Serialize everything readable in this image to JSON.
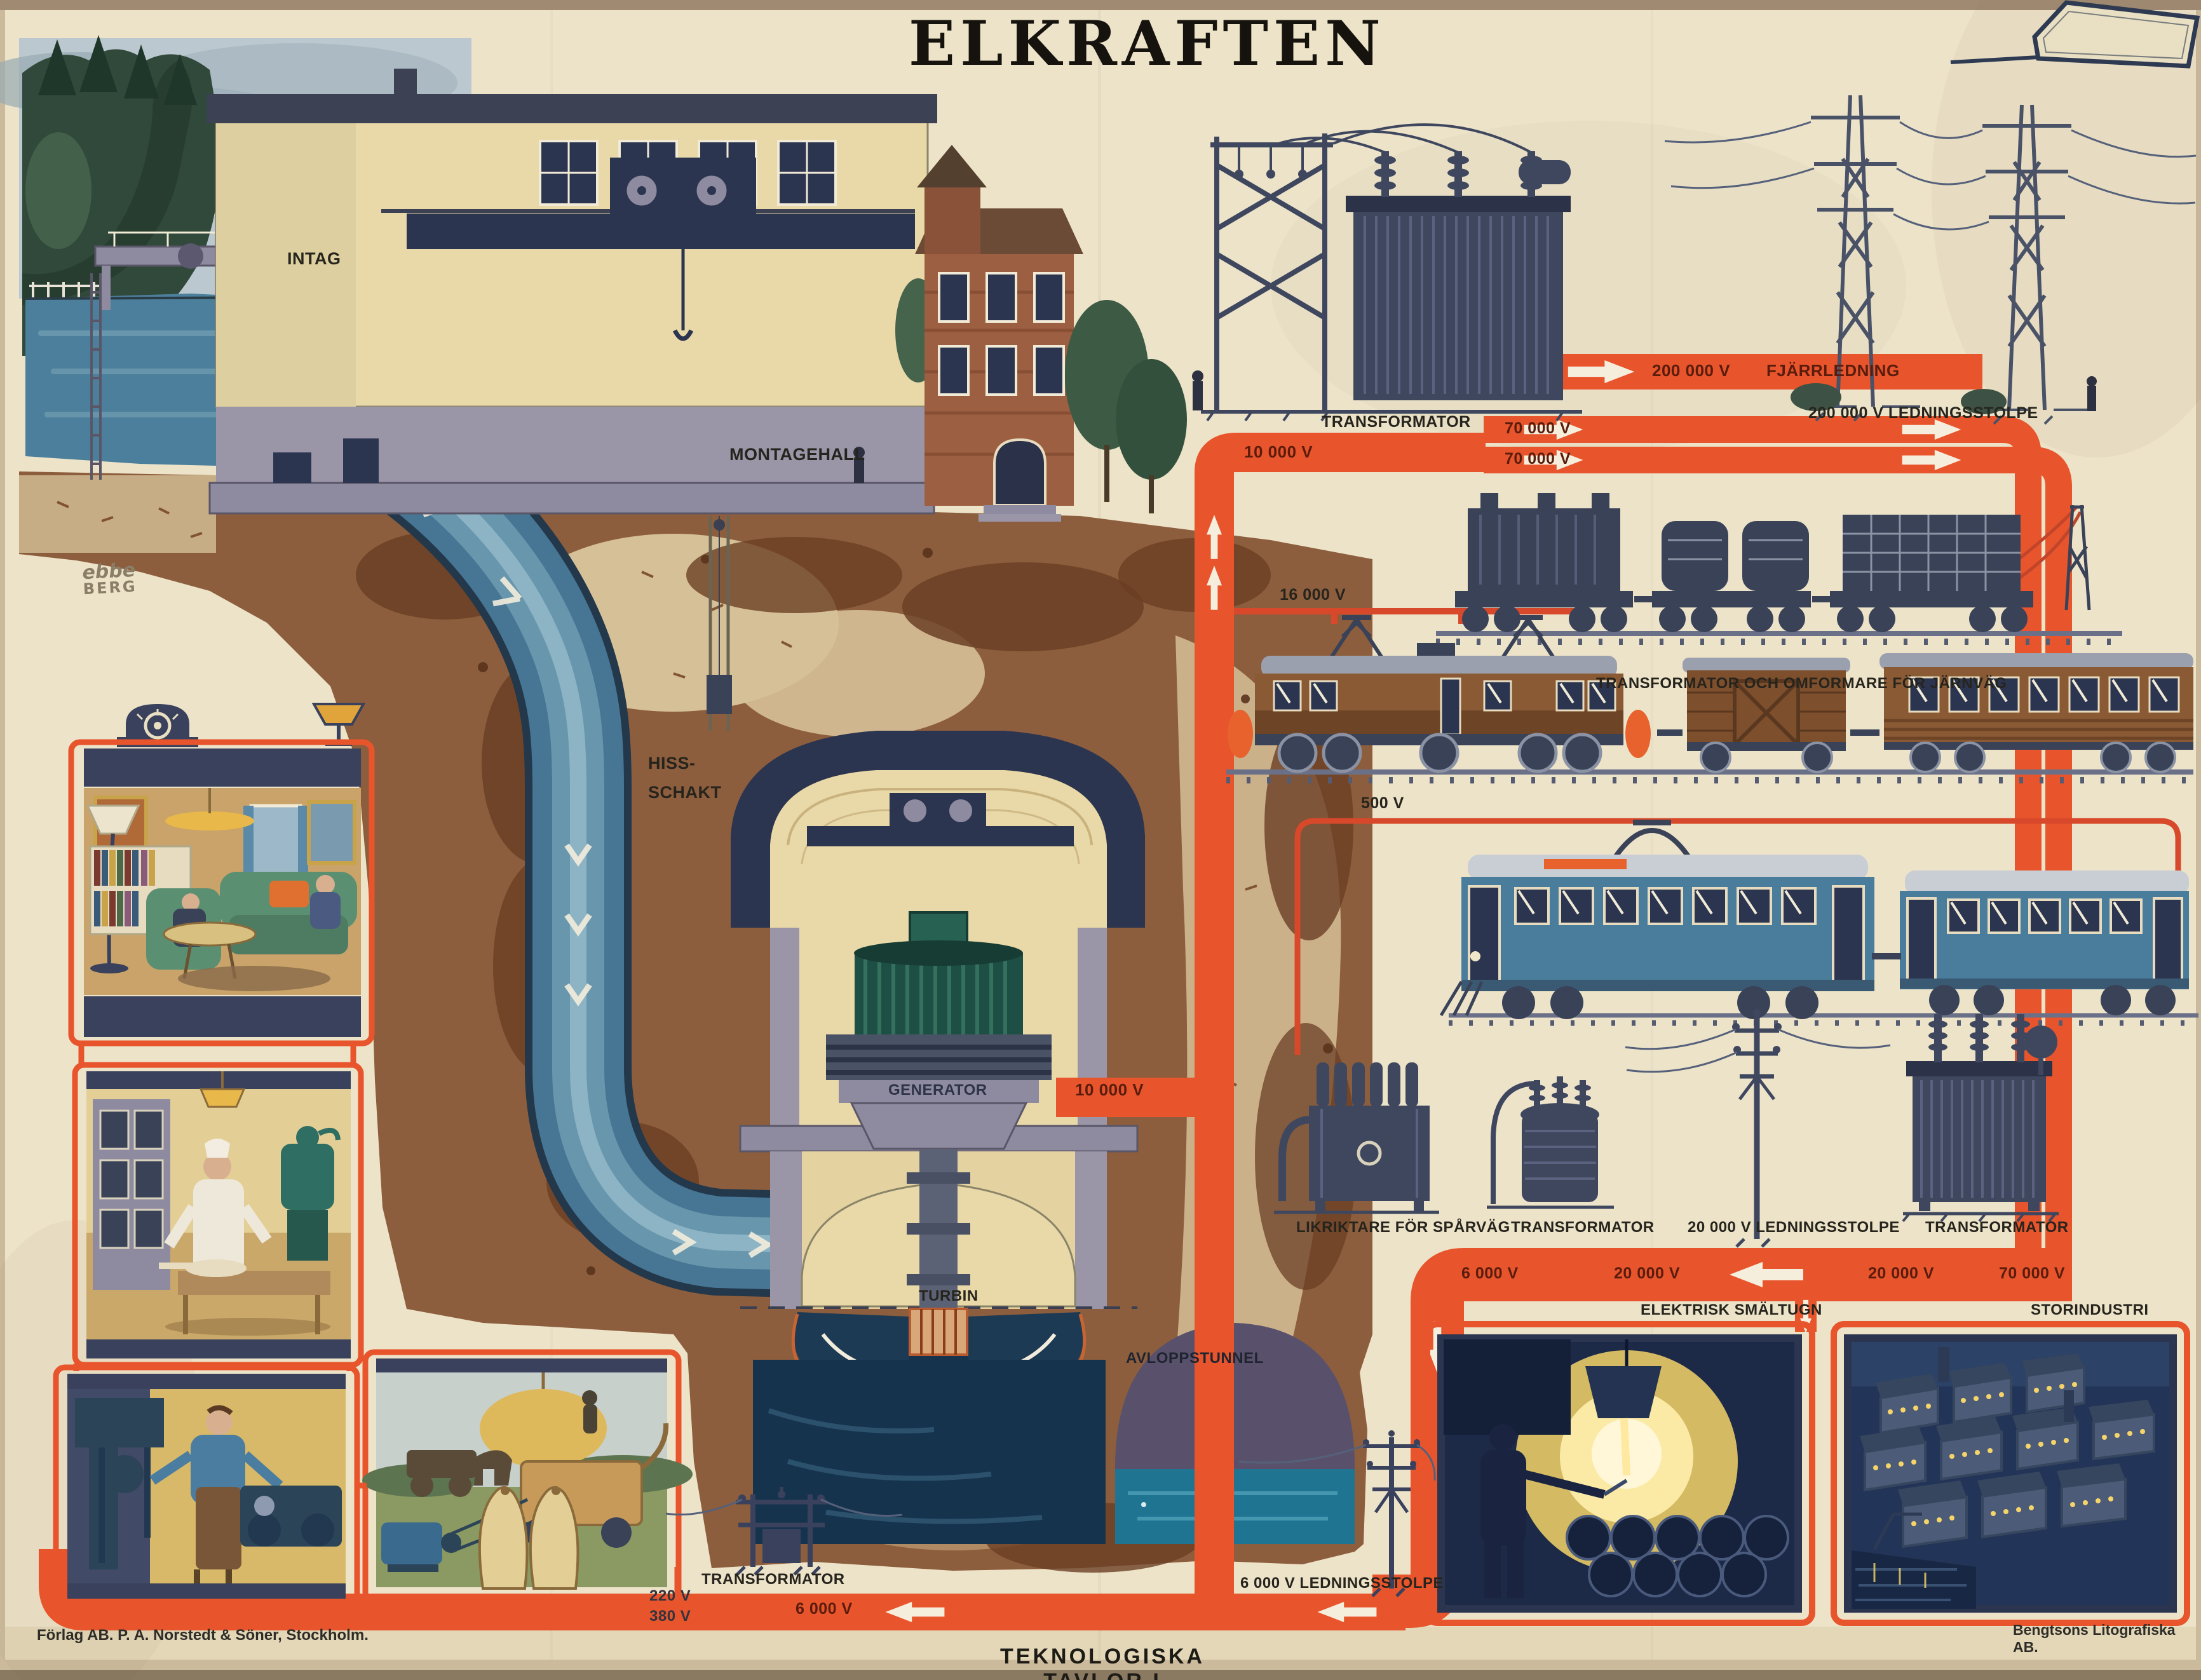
{
  "poster": {
    "title": "ELKRAFTEN",
    "series_title": "TEKNOLOGISKA TAVLOR I",
    "publisher": "Förlag AB. P. A. Norstedt & Söner, Stockholm.",
    "printer": "Bengtsons Litografiska AB.",
    "artist": {
      "first": "ebbe",
      "last": "BERG"
    }
  },
  "plant": {
    "intake": "INTAG",
    "assembly_hall": "MONTAGEHALL",
    "lift_shaft_line1": "HISS-",
    "lift_shaft_line2": "SCHAKT",
    "generator": "GENERATOR",
    "turbine": "TURBIN",
    "tailrace": "AVLOPPSTUNNEL",
    "generator_voltage": "10 000 V"
  },
  "grid": {
    "station_transformer": "TRANSFORMATOR",
    "feeder_voltage": "10 000 V",
    "hv_line1": "70 000 V",
    "hv_line2": "70 000 V",
    "trunk_voltage": "200 000 V",
    "trunk_label": "FJÄRRLEDNING",
    "trunk_pylon": "200 000 V LEDNINGSSTOLPE",
    "railway_voltage": "16 000 V",
    "railway_caption": "TRANSFORMATOR OCH OMFORMARE FÖR JÄRNVÄG",
    "tram_voltage": "500 V",
    "rectifier": "LIKRIKTARE FÖR SPÅRVÄG",
    "town_transformer": "TRANSFORMATOR",
    "town_pylon": "20 000 V LEDNINGSSTOLPE",
    "industry_transformer": "TRANSFORMATOR",
    "band_v6000": "6 000 V",
    "band_v20000_a": "20 000 V",
    "band_v20000_b": "20 000 V",
    "band_v70000": "70 000 V",
    "furnace": "ELEKTRISK SMÄLTUGN",
    "industry": "STORINDUSTRI",
    "local_transformer": "TRANSFORMATOR",
    "local_pylon": "6 000 V LEDNINGSSTOLPE",
    "home_v1": "220 V",
    "home_v2": "380 V",
    "home_feed": "6 000 V"
  },
  "colors": {
    "paper": "#ece3c9",
    "band_orange": "#e8552c",
    "line_navy": "#3a4258",
    "label_maroon": "#5a1c0c",
    "water_blue": "#477594",
    "glow_yellow": "#f5d469"
  }
}
